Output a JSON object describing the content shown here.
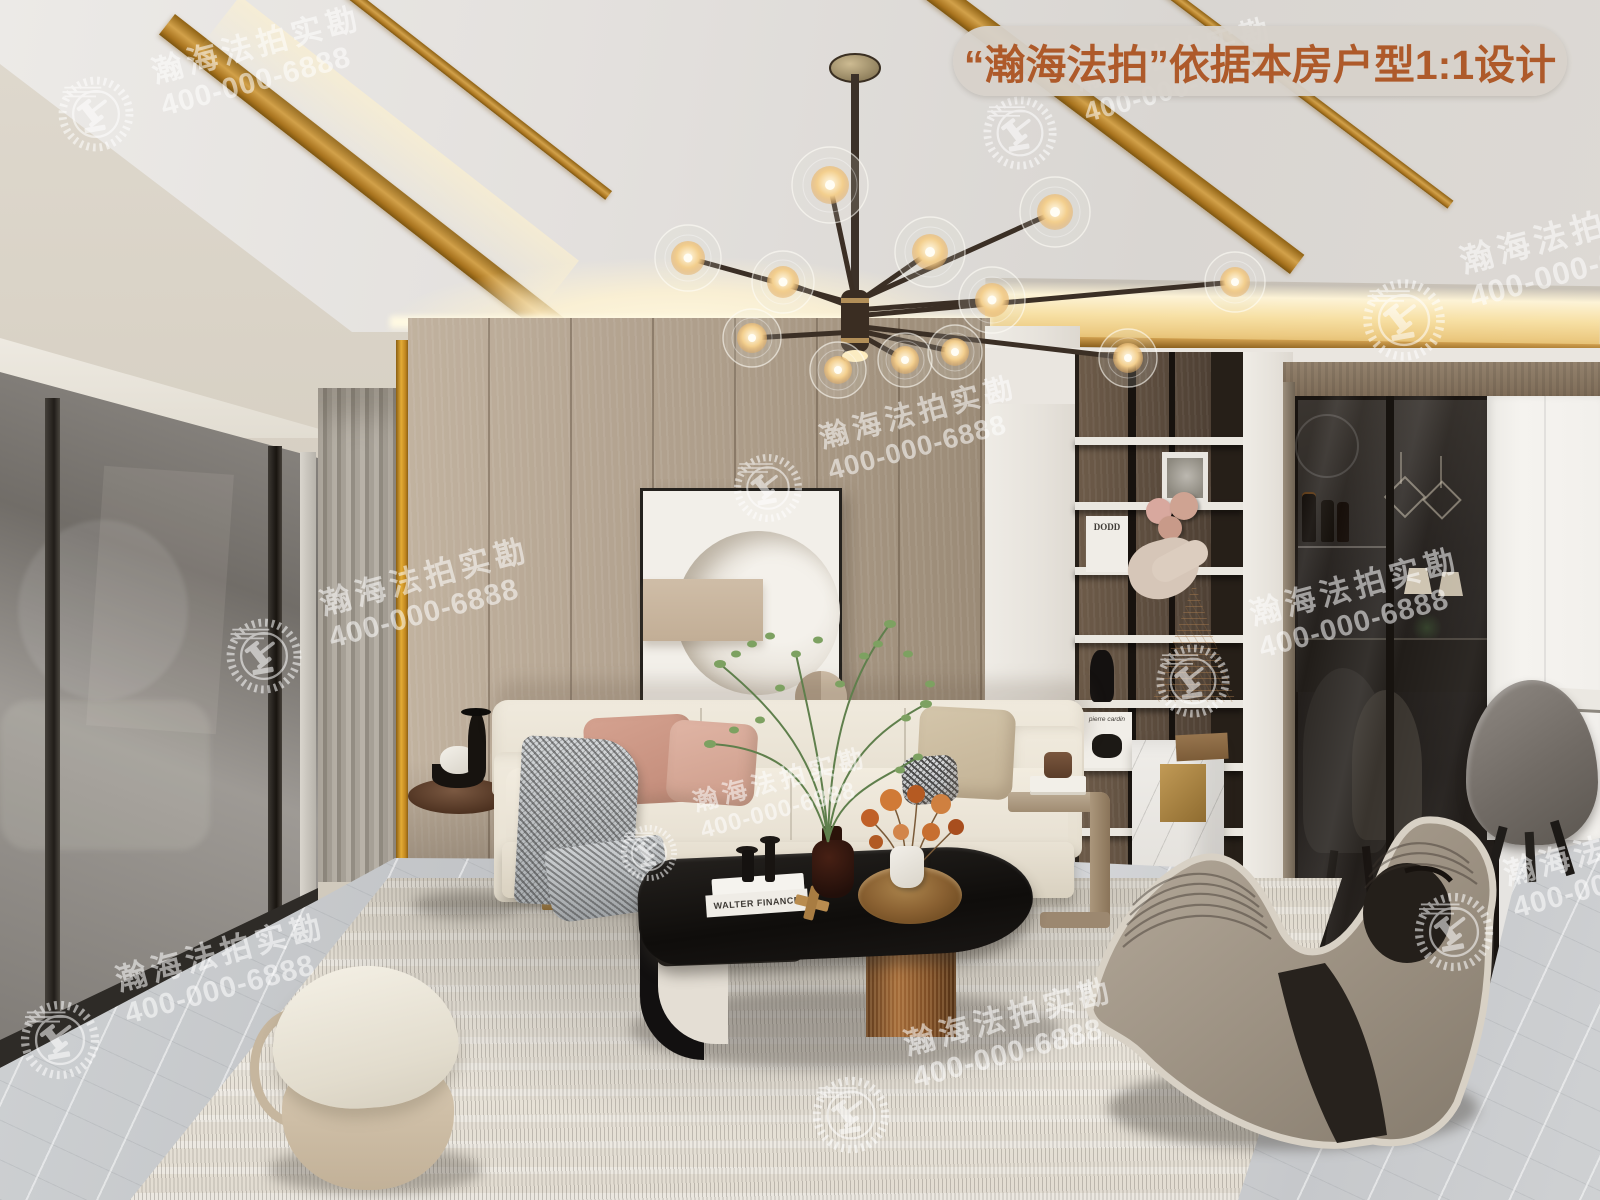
{
  "banner": {
    "label": "“瀚海法拍”依据本房户型1:1设计",
    "bg_color": "#d7d2ca",
    "text_color": "#ae5a2a"
  },
  "watermark": {
    "line1": "瀚海法拍实勘",
    "line2": "400-000-6888",
    "logo": "gavel-wreath-logo",
    "color": "#ffffff",
    "opacity": 0.55,
    "instances": [
      {
        "lx": 52,
        "ly": 70,
        "ls": 88,
        "tx": 148,
        "ty": 56,
        "s": 1
      },
      {
        "lx": 977,
        "ly": 90,
        "ls": 86,
        "tx": 1072,
        "ty": 66,
        "s": 0.95
      },
      {
        "lx": 1356,
        "ly": 272,
        "ls": 96,
        "tx": 1456,
        "ty": 244,
        "s": 1.05
      },
      {
        "lx": 220,
        "ly": 612,
        "ls": 88,
        "tx": 316,
        "ty": 588,
        "s": 1
      },
      {
        "lx": 728,
        "ly": 448,
        "ls": 80,
        "tx": 816,
        "ty": 424,
        "s": 0.95
      },
      {
        "lx": 1150,
        "ly": 638,
        "ls": 86,
        "tx": 1246,
        "ty": 598,
        "s": 1
      },
      {
        "lx": 14,
        "ly": 994,
        "ls": 92,
        "tx": 112,
        "ty": 964,
        "s": 1
      },
      {
        "lx": 616,
        "ly": 820,
        "ls": 66,
        "tx": 690,
        "ty": 790,
        "s": 0.82
      },
      {
        "lx": 806,
        "ly": 1070,
        "ls": 90,
        "tx": 900,
        "ty": 1028,
        "s": 1
      },
      {
        "lx": 1408,
        "ly": 886,
        "ls": 92,
        "tx": 1500,
        "ty": 858,
        "s": 1
      }
    ]
  },
  "decor_text": {
    "shelf_book_top": "DODD",
    "shelf_book_bottom": "pierre cardin",
    "coffee_table_book": "WALTER FINANCE"
  },
  "palette": {
    "ceiling_gold_trim": "#c89a3f",
    "wood_wall": "#b0a08c",
    "sofa_cream": "#ece6d9",
    "accent_copper": "#8a5a2e",
    "marble_floor": "#cbcdcf",
    "watermark_white": "#ffffff"
  }
}
